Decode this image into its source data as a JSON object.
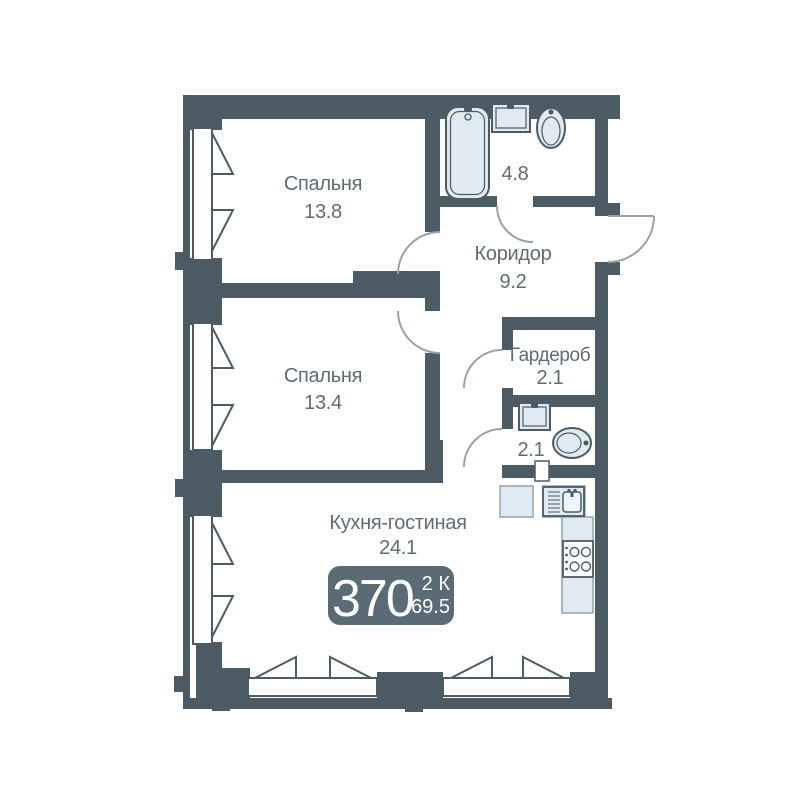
{
  "colors": {
    "wall": "#4d5b64",
    "window": "#ffffff",
    "door": "#97a1a8",
    "fixture": "#dfeaf2",
    "fixture_inner": "#eef5f9",
    "counter_stroke": "#93a4ae",
    "label": "#5f6b75",
    "badge_bg": "#5a6b75",
    "badge_text": "#ffffff"
  },
  "rooms": {
    "bedroom1": {
      "name": "Спальня",
      "area": "13.8"
    },
    "bedroom2": {
      "name": "Спальня",
      "area": "13.4"
    },
    "kitchen_living": {
      "name": "Кухня-гостиная",
      "area": "24.1"
    },
    "corridor": {
      "name": "Коридор",
      "area": "9.2"
    },
    "bathroom": {
      "area": "4.8"
    },
    "wardrobe": {
      "name": "Гардероб",
      "area": "2.1"
    },
    "wc": {
      "area": "2.1"
    }
  },
  "badge": {
    "flat_number": "370",
    "rooms_count": "2 К",
    "total_area": "69.5"
  }
}
